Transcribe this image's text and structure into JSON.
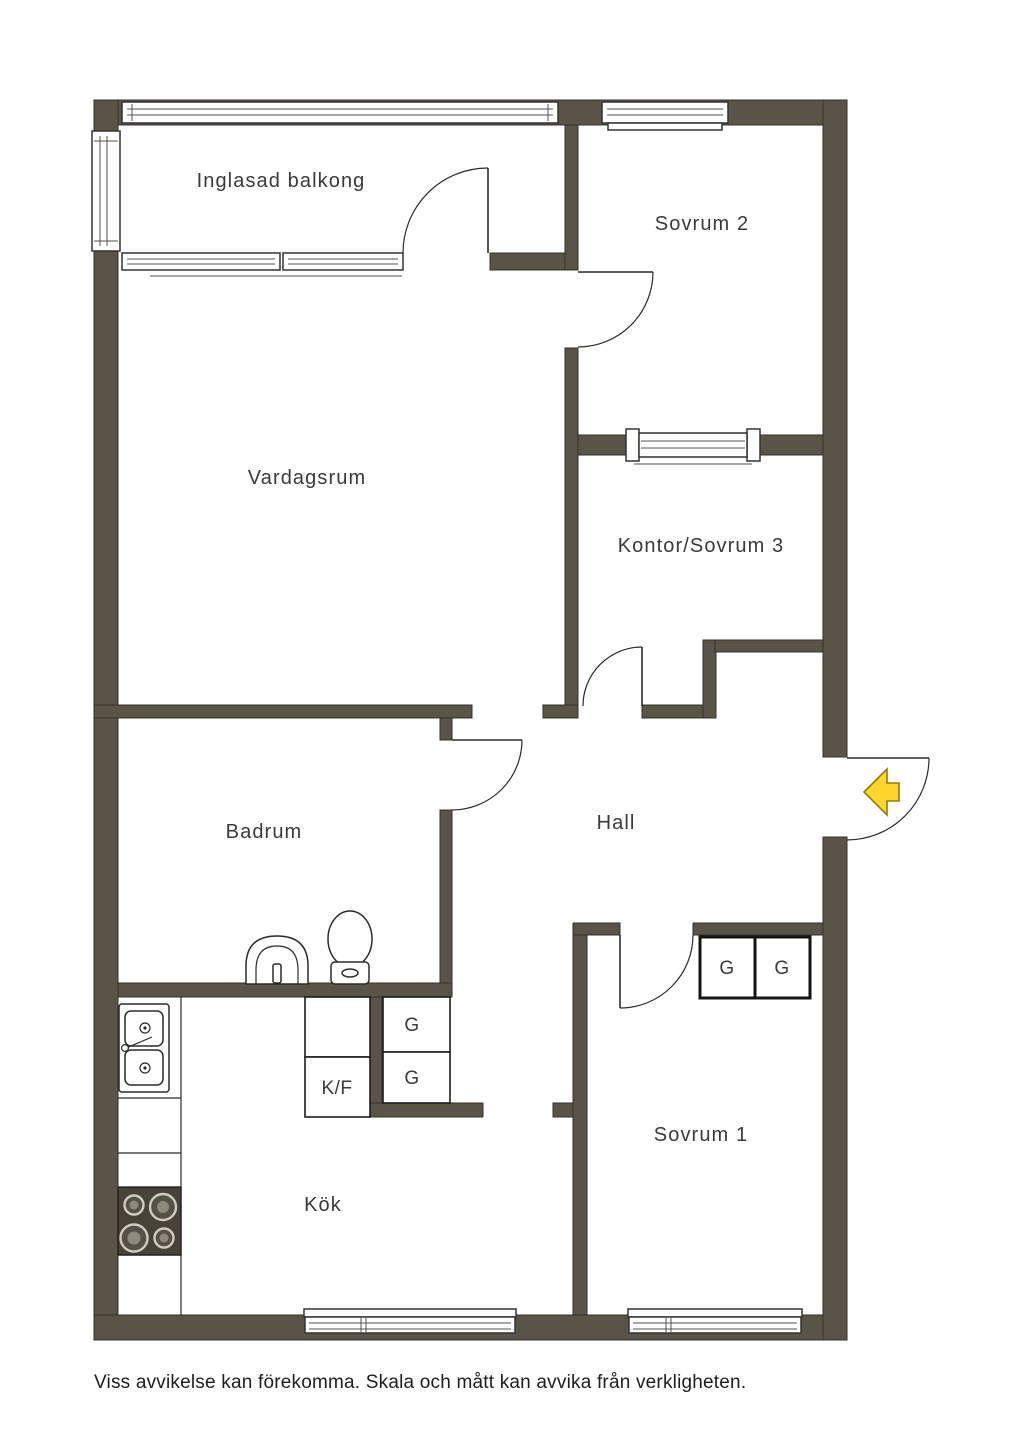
{
  "colors": {
    "wall_fill": "#5A5448",
    "wall_outline": "#35312A",
    "line": "#2B2B28",
    "label_text": "#3A3A3A",
    "arrow_fill": "#FFD52E",
    "arrow_outline": "#8F7D05",
    "stove_fill": "#474338",
    "background": "#FFFFFF"
  },
  "rooms": {
    "balcony": {
      "label": "Inglasad balkong"
    },
    "bedroom2": {
      "label": "Sovrum 2"
    },
    "living": {
      "label": "Vardagsrum"
    },
    "office": {
      "label": "Kontor/Sovrum 3"
    },
    "bathroom": {
      "label": "Badrum"
    },
    "hall": {
      "label": "Hall"
    },
    "bedroom1": {
      "label": "Sovrum 1"
    },
    "kitchen": {
      "label": "Kök"
    }
  },
  "fixtures": {
    "wardrobe": "G",
    "fridge_freezer": "K/F"
  },
  "entrance": {
    "arrow_direction": "left"
  },
  "footer": {
    "disclaimer": "Viss avvikelse kan förekomma. Skala och mått kan avvika från verkligheten."
  }
}
